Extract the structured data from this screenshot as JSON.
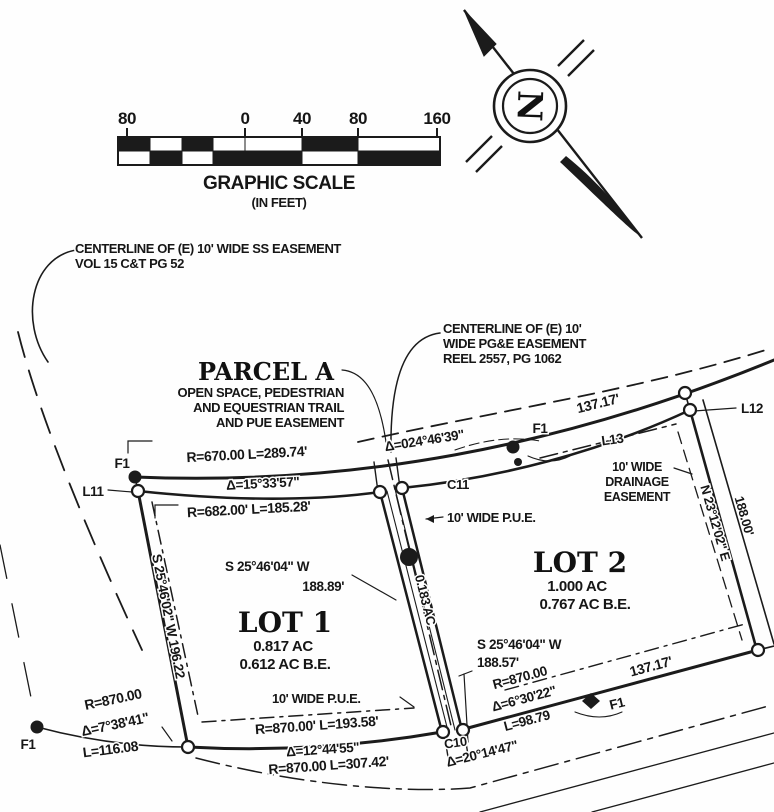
{
  "scale": {
    "ticks": [
      "80",
      "0",
      "40",
      "80",
      "160"
    ],
    "title": "GRAPHIC SCALE",
    "units": "(IN FEET)"
  },
  "compass": {
    "n": "N"
  },
  "notes": {
    "ss1": "CENTERLINE OF (E) 10' WIDE SS EASEMENT",
    "ss2": "VOL 15 C&T PG 52",
    "pge1": "CENTERLINE OF (E) 10'",
    "pge2": "WIDE PG&E EASEMENT",
    "pge3": "REEL 2557, PG 1062",
    "dr1": "10' WIDE",
    "dr2": "DRAINAGE",
    "dr3": "EASEMENT",
    "pue_top": "10' WIDE P.U.E.",
    "pue_bottom": "10' WIDE P.U.E."
  },
  "parcelA": {
    "title": "PARCEL A",
    "l1": "OPEN SPACE, PEDESTRIAN",
    "l2": "AND EQUESTRIAN TRAIL",
    "l3": "AND PUE EASEMENT"
  },
  "lot1": {
    "name": "LOT 1",
    "area": "0.817 AC",
    "be": "0.612 AC B.E."
  },
  "lot2": {
    "name": "LOT 2",
    "area": "1.000 AC",
    "be": "0.767 AC B.E."
  },
  "strip": {
    "area": "0.183 AC"
  },
  "dims": {
    "r670": "R=670.00 L=289.74'",
    "d15": "Δ=15°33'57\"",
    "r682": "R=682.00' L=185.28'",
    "d024": "Δ=024°46'39\"",
    "len137top": "137.17'",
    "lot1e_brg": "S 25°46'04\" W",
    "lot1e_len": "188.89'",
    "west_brg": "S 25°46'02\" W 196.22",
    "lot2w_brg": "S 25°46'04\" W",
    "lot2w_len": "188.57'",
    "ne_brg": "N 23°12'02\" E",
    "ne_len": "188.00'",
    "r870a": "R=870.00",
    "d738": "Δ=7°38'41\"",
    "l116": "L=116.08",
    "r870b": "R=870.00' L=193.58'",
    "d1244": "Δ=12°44'55\"",
    "r870c": "R=870.00 L=307.42'",
    "d2014": "Δ=20°14'47\"",
    "r870d": "R=870.00",
    "d630": "Δ=6°30'22\"",
    "l98": "L=98.79",
    "len137bot": "137.17'"
  },
  "markers": {
    "f1a": "F1",
    "f1b": "F1",
    "f1c": "F1",
    "f1d": "F1",
    "l11": "L11",
    "l12": "L12",
    "l13": "L13",
    "c11": "C11",
    "c10": "C10"
  }
}
